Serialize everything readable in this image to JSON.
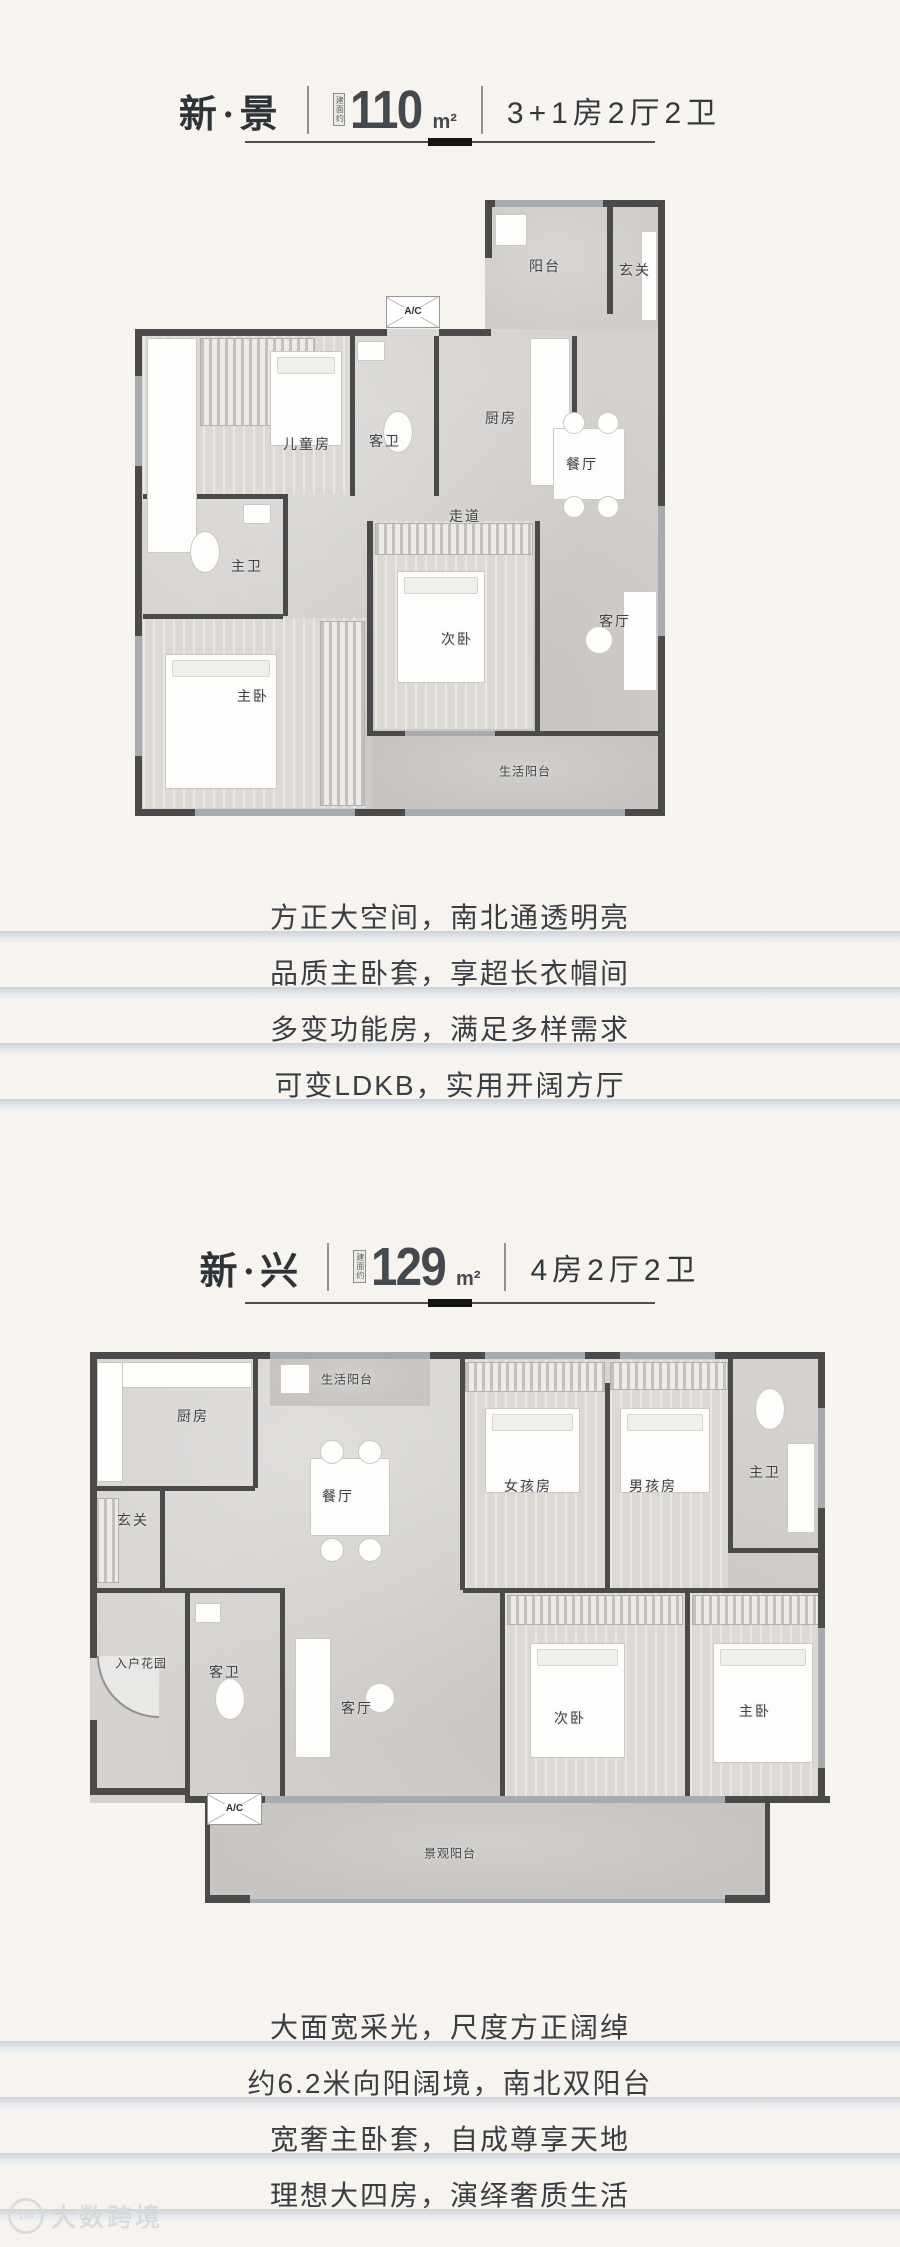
{
  "page": {
    "background": "#f7f4ef"
  },
  "watermark": {
    "brand": "大数跨境",
    "logo_text": "100"
  },
  "plans": [
    {
      "name": "新·景",
      "area_prefix": "建面约",
      "area_value": "110",
      "area_unit": "m²",
      "spec": "3+1房2厅2卫",
      "ac_label": "A/C",
      "rooms": [
        {
          "label": "阳台",
          "x": 410,
          "y": 80
        },
        {
          "label": "玄关",
          "x": 500,
          "y": 84
        },
        {
          "label": "儿童房",
          "x": 172,
          "y": 258
        },
        {
          "label": "客卫",
          "x": 250,
          "y": 255
        },
        {
          "label": "厨房",
          "x": 366,
          "y": 232
        },
        {
          "label": "餐厅",
          "x": 447,
          "y": 278
        },
        {
          "label": "走道",
          "x": 330,
          "y": 330
        },
        {
          "label": "主卫",
          "x": 112,
          "y": 380
        },
        {
          "label": "次卧",
          "x": 322,
          "y": 453
        },
        {
          "label": "客厅",
          "x": 480,
          "y": 435
        },
        {
          "label": "主卧",
          "x": 118,
          "y": 510
        },
        {
          "label": "生活阳台",
          "x": 390,
          "y": 585
        }
      ],
      "features": [
        "方正大空间，南北通透明亮",
        "品质主卧套，享超长衣帽间",
        "多变功能房，满足多样需求",
        "可变LDKB，实用开阔方厅"
      ]
    },
    {
      "name": "新·兴",
      "area_prefix": "建面约",
      "area_value": "129",
      "area_unit": "m²",
      "spec": "4房2厅2卫",
      "ac_label": "A/C",
      "rooms": [
        {
          "label": "生活阳台",
          "x": 282,
          "y": 31
        },
        {
          "label": "厨房",
          "x": 128,
          "y": 68
        },
        {
          "label": "玄关",
          "x": 68,
          "y": 172
        },
        {
          "label": "餐厅",
          "x": 273,
          "y": 148
        },
        {
          "label": "女孩房",
          "x": 463,
          "y": 138
        },
        {
          "label": "男孩房",
          "x": 588,
          "y": 138
        },
        {
          "label": "主卫",
          "x": 700,
          "y": 124
        },
        {
          "label": "入户花园",
          "x": 76,
          "y": 315
        },
        {
          "label": "客卫",
          "x": 160,
          "y": 324
        },
        {
          "label": "客厅",
          "x": 292,
          "y": 360
        },
        {
          "label": "次卧",
          "x": 505,
          "y": 370
        },
        {
          "label": "主卧",
          "x": 690,
          "y": 363
        },
        {
          "label": "景观阳台",
          "x": 385,
          "y": 505
        }
      ],
      "features": [
        "大面宽采光，尺度方正阔绰",
        "约6.2米向阳阔境，南北双阳台",
        "宽奢主卧套，自成尊享天地",
        "理想大四房，演绎奢质生活"
      ]
    }
  ]
}
